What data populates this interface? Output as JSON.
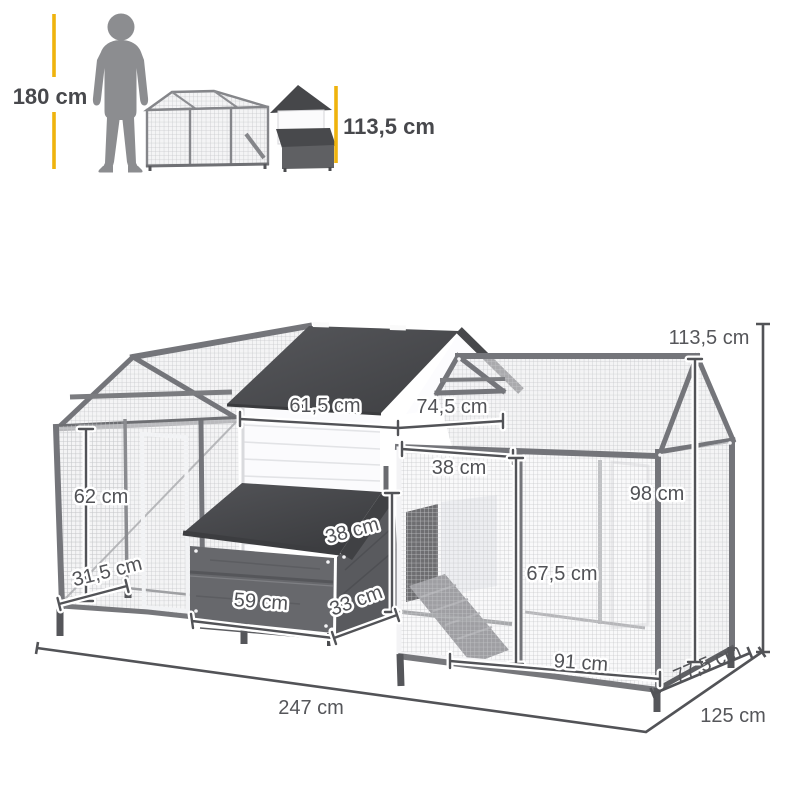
{
  "scale_reference": {
    "person_height": "180 cm",
    "coop_height": "113,5 cm"
  },
  "dimensions": {
    "house_front_width": "61,5 cm",
    "house_roof_edge": "74,5 cm",
    "run_door_width": "38 cm",
    "left_run_height": "62 cm",
    "left_run_depth": "31,5 cm",
    "right_run_height": "98 cm",
    "nest_box_height": "38 cm",
    "run_door_height": "67,5 cm",
    "nest_box_width": "59 cm",
    "nest_box_depth": "33 cm",
    "right_run_width": "91 cm",
    "right_run_depth": "77,5 cm",
    "total_height": "113,5 cm",
    "total_length": "247 cm",
    "total_depth": "125 cm"
  },
  "colors": {
    "accent_yellow": "#efb30d",
    "silhouette_gray": "#8c8d90",
    "roof_dark": "#4a4b4e",
    "frame_gray": "#74757a",
    "dimension_text": "#515256"
  }
}
